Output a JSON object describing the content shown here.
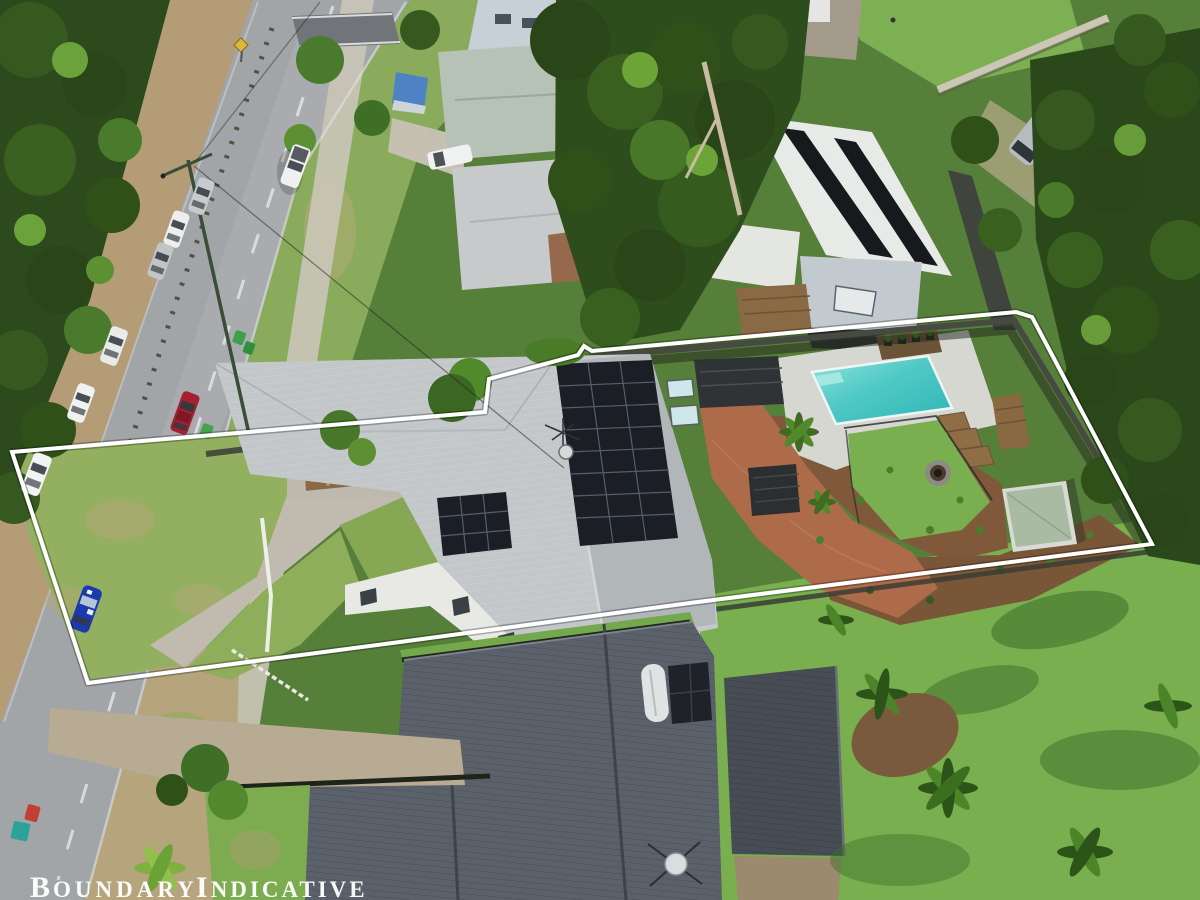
{
  "meta": {
    "description": "Aerial drone photograph of a suburban residential property with an indicative white boundary outline overlay (real-estate listing image)",
    "width_px": 1200,
    "height_px": 900
  },
  "overlay": {
    "label": "Boundary Indicative",
    "label_parts": [
      "B",
      "OUNDARY",
      "I",
      "NDICATIVE"
    ],
    "label_color": "#ffffff",
    "boundary_line_color": "#ffffff",
    "boundary_points": "12,452 485,412 489,379 578,355 584,346 592,351 1016,312 1032,317 1152,544 690,603 400,642 88,683"
  },
  "scene": {
    "subject_property": {
      "features": [
        "light-grey corrugated metal roof house",
        "large rooftop solar array",
        "small 3x3 solar array",
        "two roof skylights",
        "tv antenna and satellite dish",
        "black flat-roof pergola",
        "small black gazebo",
        "red brick garden paths",
        "mulched garden beds with young shrubs",
        "swimming pool",
        "light paved pool surround",
        "planter pots on dark deck ledge",
        "timber steps and bench deck",
        "rear lawn with round fire pit",
        "garden shed with pale green roof",
        "black pool safety fence",
        "timber back fence",
        "white front fence",
        "concrete driveway and parking pad",
        "flower garden bed",
        "front lawn with dry patches"
      ]
    },
    "street": {
      "description": "two-lane road running diagonally along the left with grass verge and footpath",
      "features": [
        "white dashed centre line",
        "concrete footpath",
        "guardrail posts on dirt verge",
        "street light pole with overhead wires",
        "dark pedestrian threshold strip",
        "yellow diamond road sign",
        "green wheelie bins",
        "red and teal wheelie bins"
      ],
      "cars": [
        {
          "type": "ute",
          "color": "white"
        },
        {
          "type": "sedan",
          "color": "silver"
        },
        {
          "type": "sedan",
          "color": "white"
        },
        {
          "type": "sedan",
          "color": "silver"
        },
        {
          "type": "wagon",
          "color": "white"
        },
        {
          "type": "sedan",
          "color": "white"
        },
        {
          "type": "sedan",
          "color": "white"
        },
        {
          "type": "sedan",
          "color": "red"
        },
        {
          "type": "sedan",
          "color": "blue"
        }
      ]
    },
    "neighbours": {
      "rear": [
        "house with white roof and two long black solar strips",
        "timber rear deck",
        "grey campervan parked in trees",
        "two-storey pale blue-grey house",
        "pale green metal roof house",
        "grey hip roof house with brick wall",
        "white ute in neighbour driveway",
        "boat under blue tarp"
      ],
      "foreground": [
        "large charcoal corrugated roof house",
        "attached dark carport",
        "solar hot water unit on roof",
        "satellite dish on roof"
      ]
    },
    "vegetation": [
      "dense gum trees along road reserve",
      "large eucalypts behind the house",
      "palms in rear tropical lawn",
      "bright palm shrubs near road"
    ]
  },
  "palette": {
    "boundary_line": "#ffffff",
    "road_surface": "#a2a5a8",
    "main_house_roof": "#c3c7c9",
    "foreground_house_roof": "#5a616a",
    "pool_water": "#49c7c4",
    "pool_paving": "#d7d7d2",
    "backyard_lawn": "#79af4f",
    "brick_path": "#ae6b4a",
    "mulch": "#80583a",
    "solar_panel": "#1b1e25",
    "tree_dark": "#2c4a1c",
    "tree_light": "#679c38",
    "verge_grass": "#8aab5c",
    "dirt_verge": "#b39c76"
  }
}
